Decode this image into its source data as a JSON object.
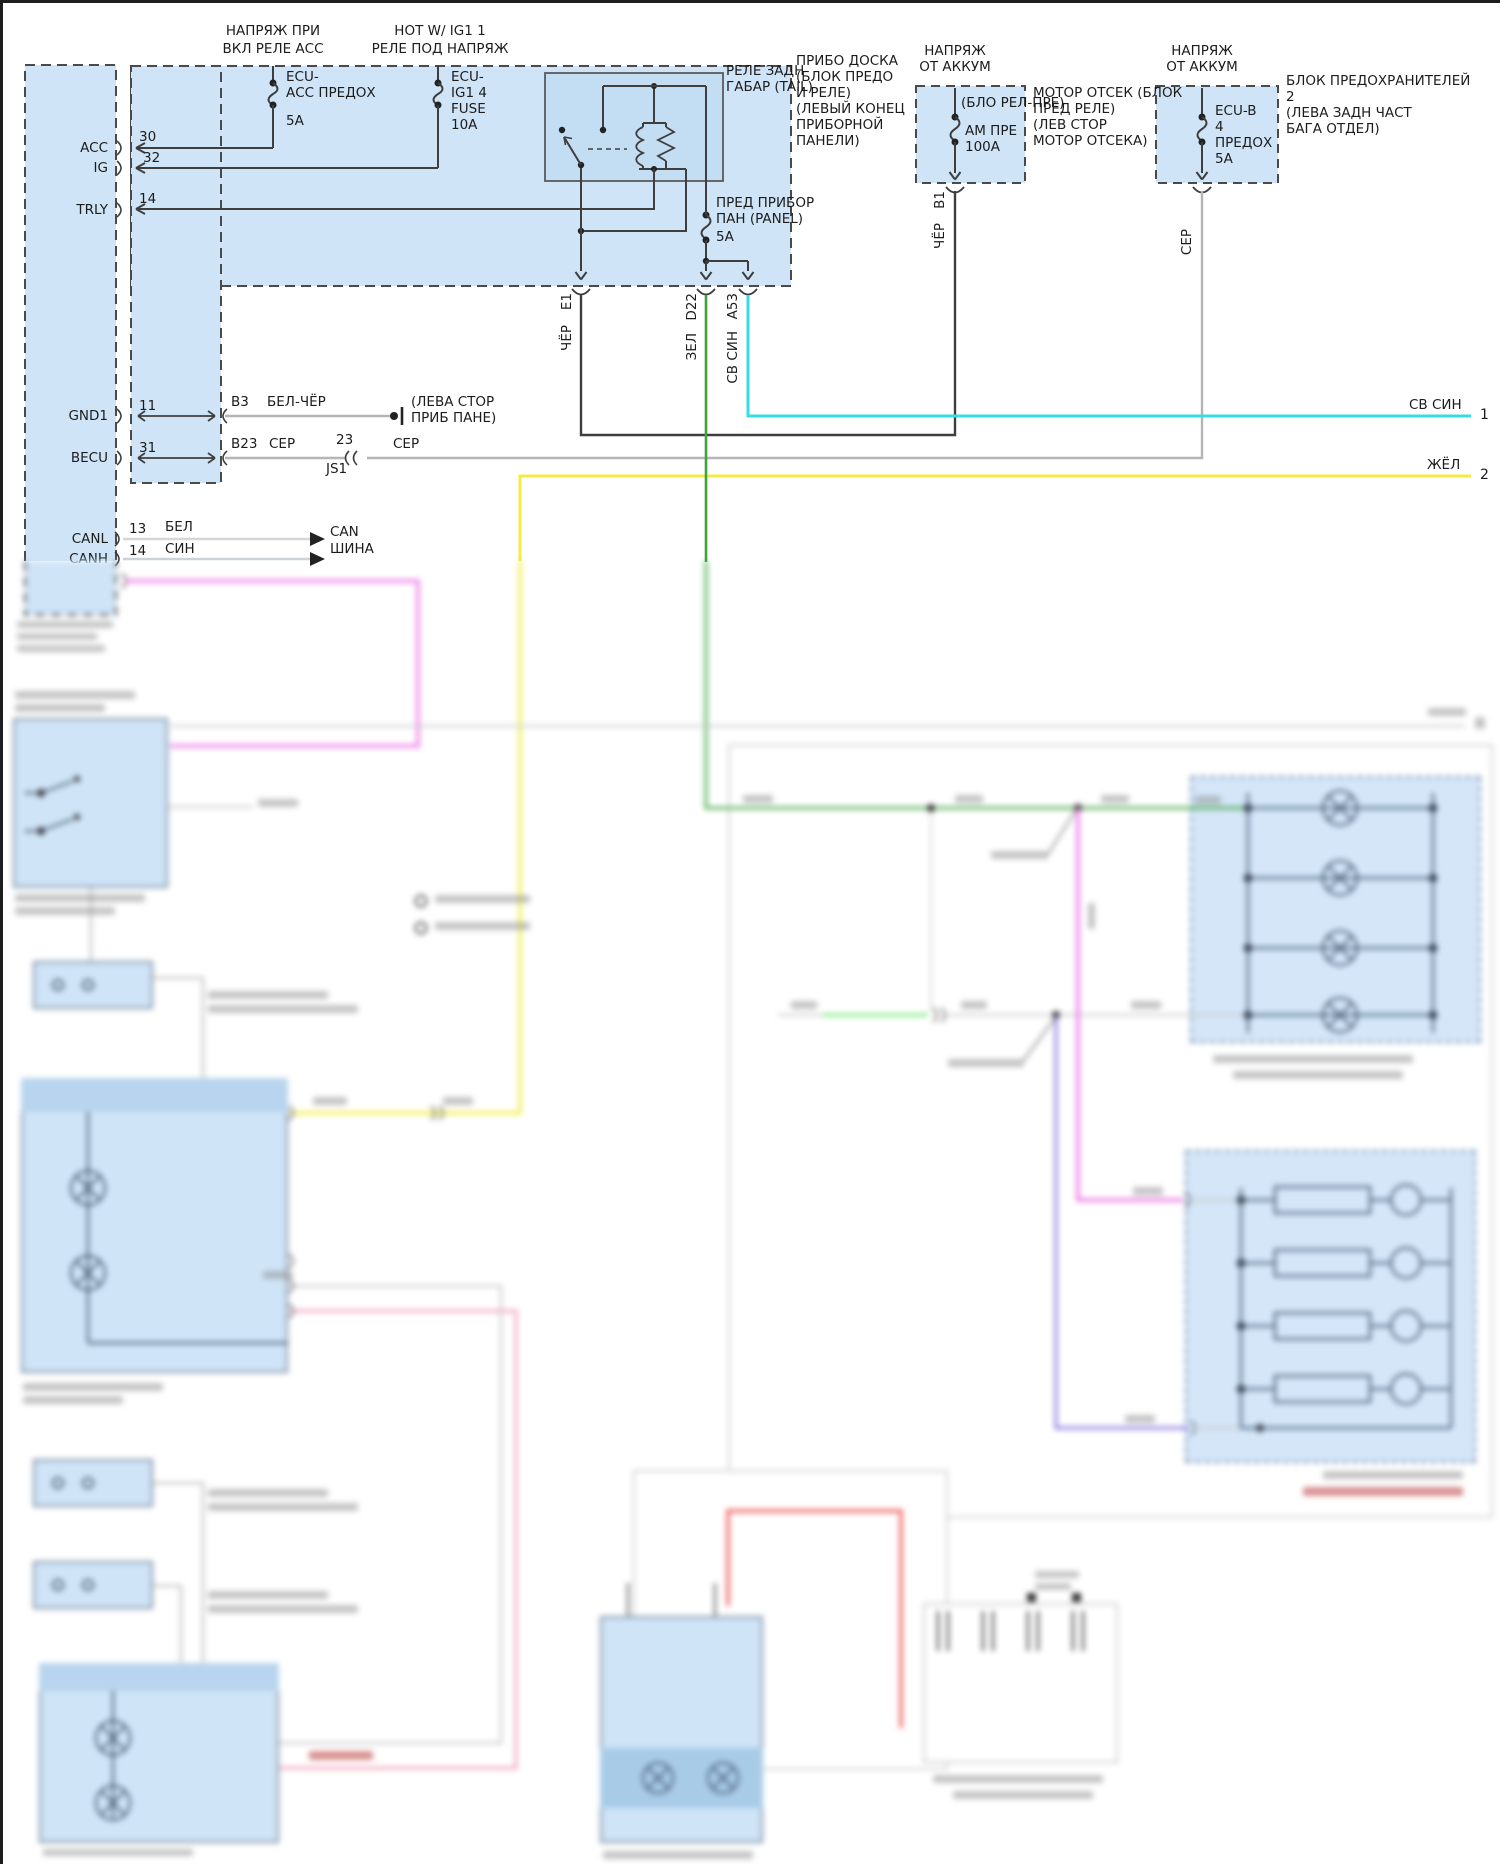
{
  "palette": {
    "frame": "#1d1d1d",
    "box_fill": "#cfe4f7",
    "box_fill_dark": "#b8d4ee",
    "relay_fill": "#c3ddf3",
    "wire_black": "#3e3e3e",
    "wire_gray": "#b5b5b5",
    "wire_white": "#d6d6d6",
    "wire_green": "#3da43d",
    "wire_bright_green": "#7ce87c",
    "wire_cyan": "#35dce4",
    "wire_yellow": "#f1ec3f",
    "wire_pink": "#ee86e8",
    "wire_purple": "#8f7ce0",
    "wire_red": "#f06868",
    "wire_salmon": "#f2a9c0"
  },
  "headers": {
    "acc_relay_1": "НАПРЯЖ ПРИ",
    "acc_relay_2": "ВКЛ РЕЛЕ АСС",
    "ig1_hot_1": "HOT W/ IG1 1",
    "ig1_hot_2": "РЕЛЕ ПОД НАПРЯЖ",
    "batt_1": "НАПРЯЖ",
    "batt_2": "ОТ АККУМ"
  },
  "fuses": {
    "acc": {
      "l1": "ECU-",
      "l2": "АСС ПРЕДОХ",
      "rating": "5А"
    },
    "ig1": {
      "l1": "ECU-",
      "l2": "IG1 4",
      "l3": "FUSE",
      "rating": "10А"
    },
    "panel": {
      "l1": "ПРЕД ПРИБОР",
      "l2": "ПАН (PANEL)",
      "rating": "5А"
    },
    "am": {
      "l1": "АМ ПРЕ",
      "rating": "100А"
    },
    "ecu_b": {
      "l1": "ECU-B",
      "l2": "4",
      "l3": "ПРЕДОХ",
      "rating": "5А"
    }
  },
  "relay": {
    "l1": "РЕЛЕ ЗАДН",
    "l2": "ГАБАР (TAIL)"
  },
  "notes": {
    "panel_block": [
      "ПРИБО ДОСКА",
      "(БЛОК ПРЕДО",
      "И РЕЛЕ)",
      "(ЛЕВЫЙ КОНЕЦ",
      "ПРИБОРНОЙ",
      "ПАНЕЛИ)"
    ],
    "relay_block": "(БЛО РЕЛ-ПРЕ)",
    "engine_room": [
      "МОТОР ОТСЕК (БЛОК",
      "ПРЕД РЕЛЕ)",
      "(ЛЕВ СТОР",
      "МОТОР ОТСЕКА)"
    ],
    "fuse_block_2": [
      "БЛОК ПРЕДОХРАНИТЕЛЕЙ",
      "2",
      "(ЛЕВА ЗАДН ЧАСТ",
      "БАГА ОТДЕЛ)"
    ],
    "ground": [
      "(ЛЕВА СТОР",
      "ПРИБ ПАНЕ)"
    ]
  },
  "ecu": {
    "pins": {
      "acc": "ACC",
      "ig": "IG",
      "trly": "TRLY",
      "gnd1": "GND1",
      "becu": "BECU",
      "canl": "CANL",
      "canh": "CANH"
    },
    "pin_numbers": {
      "acc": "30",
      "ig": "32",
      "trly": "14",
      "gnd1": "11",
      "becu": "31",
      "canl": "13",
      "canh": "14"
    }
  },
  "connectors": {
    "e1": "E1",
    "d22": "D22",
    "a53": "A53",
    "b1": "B1",
    "b3": "B3",
    "b23": "B23",
    "js1": "JS1",
    "js1_pin": "23"
  },
  "wire_labels": {
    "cher_e1": "ЧЁР",
    "zel": "ЗЕЛ",
    "sv_sin_a53": "СВ СИН",
    "cher_b1": "ЧЁР",
    "ser_ecub": "СЕР",
    "bel_cher": "БЕЛ-ЧЁР",
    "ser_1": "СЕР",
    "ser_2": "СЕР",
    "bel": "БЕЛ",
    "sin": "СИН"
  },
  "can_bus": {
    "l1": "CAN",
    "l2": "ШИНА"
  },
  "page_refs": {
    "ref1": {
      "wire": "СВ СИН",
      "num": "1"
    },
    "ref2": {
      "wire": "ЖЁЛ",
      "num": "2"
    }
  }
}
